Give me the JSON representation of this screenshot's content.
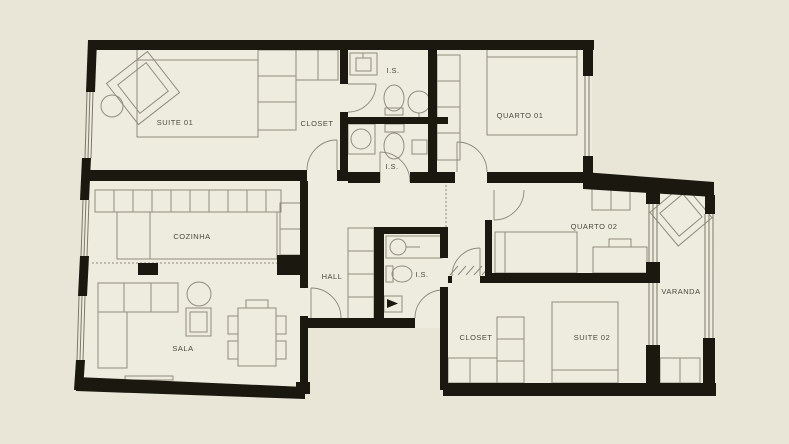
{
  "title": "Apartment floor plan",
  "colors": {
    "background": "#e9e6d8",
    "floor": "#eeecde",
    "wall": "#1a180f",
    "furniture_line": "#908d7e",
    "label_text": "#4c4a3f"
  },
  "rooms": [
    {
      "id": "suite-01",
      "label": "SUITE  01"
    },
    {
      "id": "closet-1",
      "label": "CLOSET"
    },
    {
      "id": "is-1",
      "label": "I.S."
    },
    {
      "id": "is-2",
      "label": "I.S."
    },
    {
      "id": "quarto-01",
      "label": "QUARTO 01"
    },
    {
      "id": "cozinha",
      "label": "COZINHA"
    },
    {
      "id": "hall",
      "label": "HALL"
    },
    {
      "id": "is-3",
      "label": "I.S."
    },
    {
      "id": "quarto-02",
      "label": "QUARTO  02"
    },
    {
      "id": "varanda",
      "label": "VARANDA"
    },
    {
      "id": "sala",
      "label": "SALA"
    },
    {
      "id": "closet-2",
      "label": "CLOSET"
    },
    {
      "id": "suite-02",
      "label": "SUITE  02"
    }
  ],
  "fixtures": [
    "bed",
    "rug",
    "side-table",
    "wardrobe-shelves",
    "sink",
    "toilet",
    "pedestal-sink",
    "shower",
    "kitchen-counter",
    "fridge",
    "sofa",
    "armchair",
    "dining-table",
    "desk",
    "bench",
    "duct-shaft",
    "door",
    "window"
  ]
}
